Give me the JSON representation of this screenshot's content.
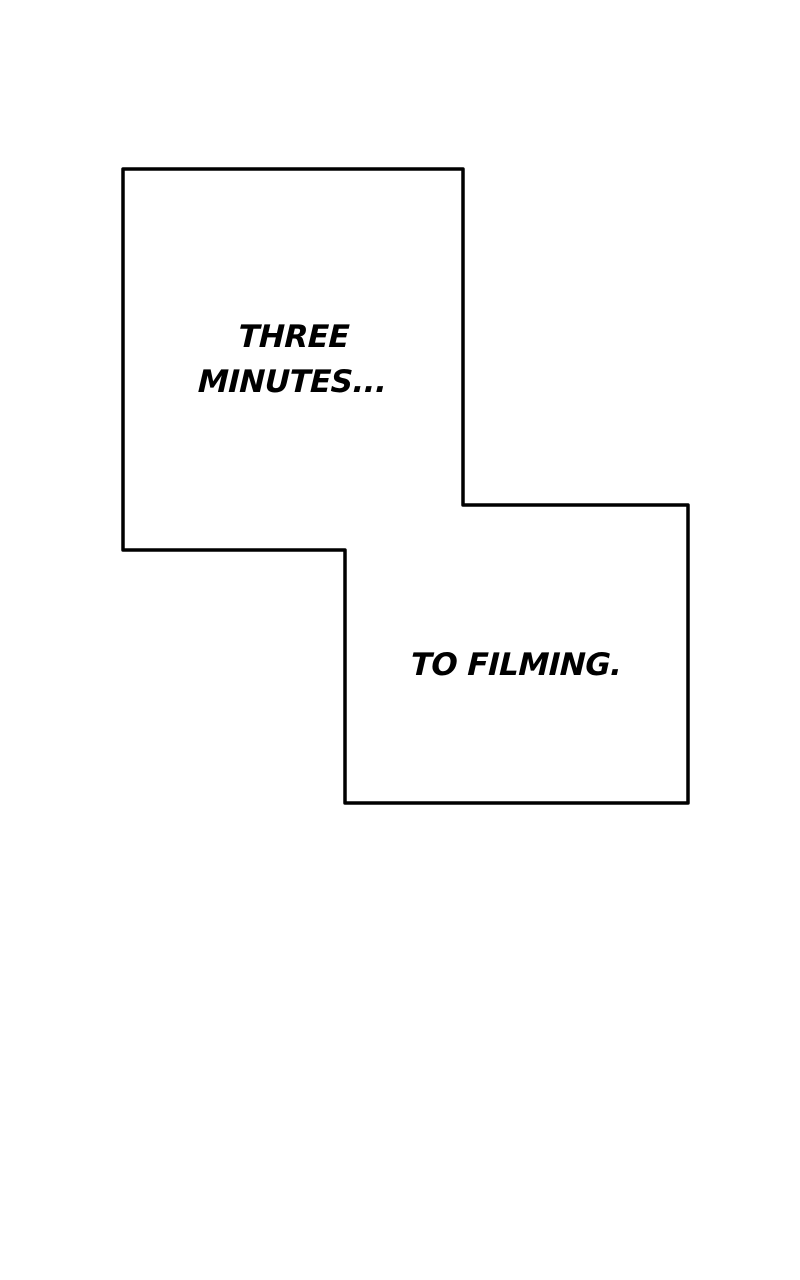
{
  "canvas": {
    "background_color": "#ffffff"
  },
  "comic": {
    "outline_color": "#000000",
    "panel_fill_color": "#ffffff",
    "text_color": "#000000",
    "caption_top": {
      "line1": "THREE",
      "line2": "MINUTES..."
    },
    "caption_bottom": {
      "text": "TO FILMING."
    }
  }
}
